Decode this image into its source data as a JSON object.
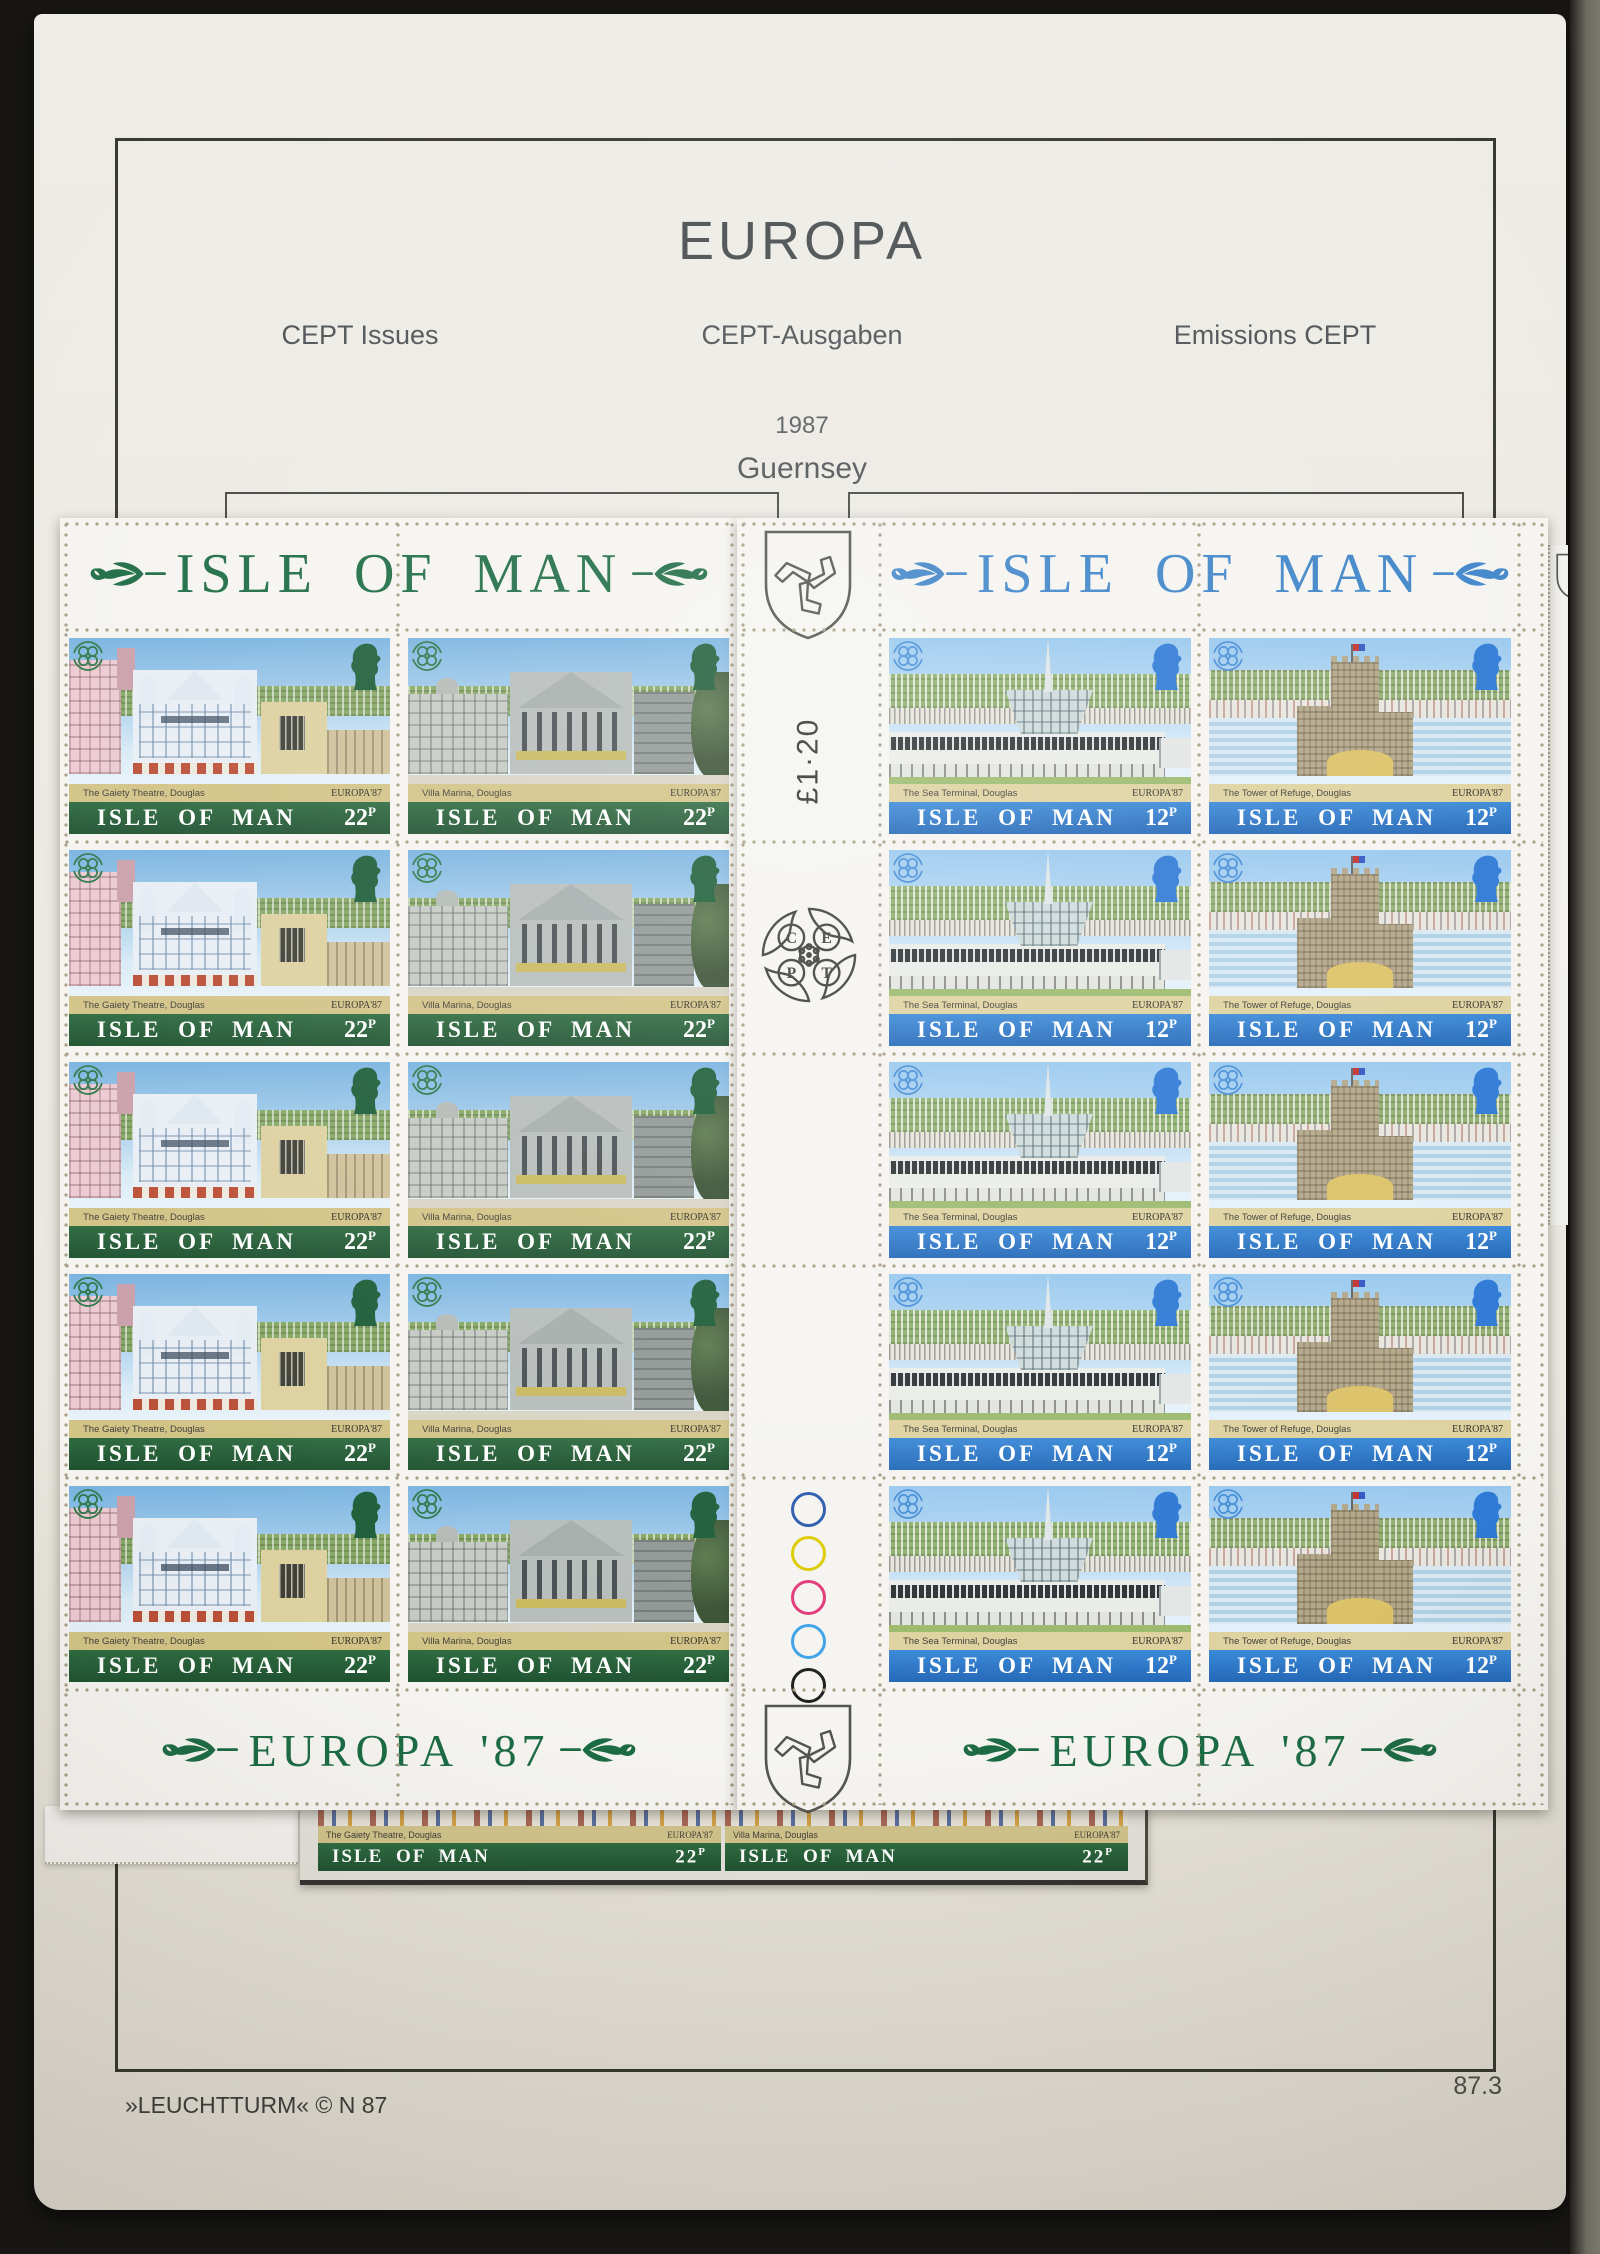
{
  "album": {
    "title": "EUROPA",
    "subtitle_left": "CEPT Issues",
    "subtitle_center": "CEPT-Ausgaben",
    "subtitle_right": "Emissions CEPT",
    "year": "1987",
    "country": "Guernsey",
    "publisher": "»LEUCHTTURM«  © N 87",
    "page_number": "87.3"
  },
  "sheet_left": {
    "title": "ISLE OF MAN",
    "banner": "EUROPA '87",
    "title_color": "#1c6b44",
    "rows": 5,
    "stamps": [
      {
        "caption": "The Gaiety Theatre, Douglas",
        "issue": "EUROPA'87",
        "country": "ISLE OF MAN",
        "value": "22",
        "unit": "P"
      },
      {
        "caption": "Villa Marina, Douglas",
        "issue": "EUROPA'87",
        "country": "ISLE OF MAN",
        "value": "22",
        "unit": "P"
      }
    ]
  },
  "sheet_right": {
    "title": "ISLE OF MAN",
    "banner": "EUROPA '87",
    "title_color": "#3e84c8",
    "rows": 5,
    "gutter": {
      "sheet_value": "£1·20",
      "cept_letters": [
        "C",
        "E",
        "P",
        "T"
      ],
      "traffic_lights": [
        "#2b5cad",
        "#ddca00",
        "#e23a78",
        "#3fa3e8",
        "#1f1f1f"
      ]
    },
    "stamps": [
      {
        "caption": "The Sea Terminal, Douglas",
        "issue": "EUROPA'87",
        "country": "ISLE OF MAN",
        "value": "12",
        "unit": "P"
      },
      {
        "caption": "The Tower of Refuge, Douglas",
        "issue": "EUROPA'87",
        "country": "ISLE OF MAN",
        "value": "12",
        "unit": "P"
      }
    ]
  },
  "strip": {
    "stamps": [
      {
        "caption": "The Gaiety Theatre, Douglas",
        "issue": "EUROPA'87",
        "country": "ISLE OF MAN",
        "value": "22",
        "unit": "P"
      },
      {
        "caption": "Villa Marina, Douglas",
        "issue": "EUROPA'87",
        "country": "ISLE OF MAN",
        "value": "22",
        "unit": "P"
      }
    ]
  }
}
